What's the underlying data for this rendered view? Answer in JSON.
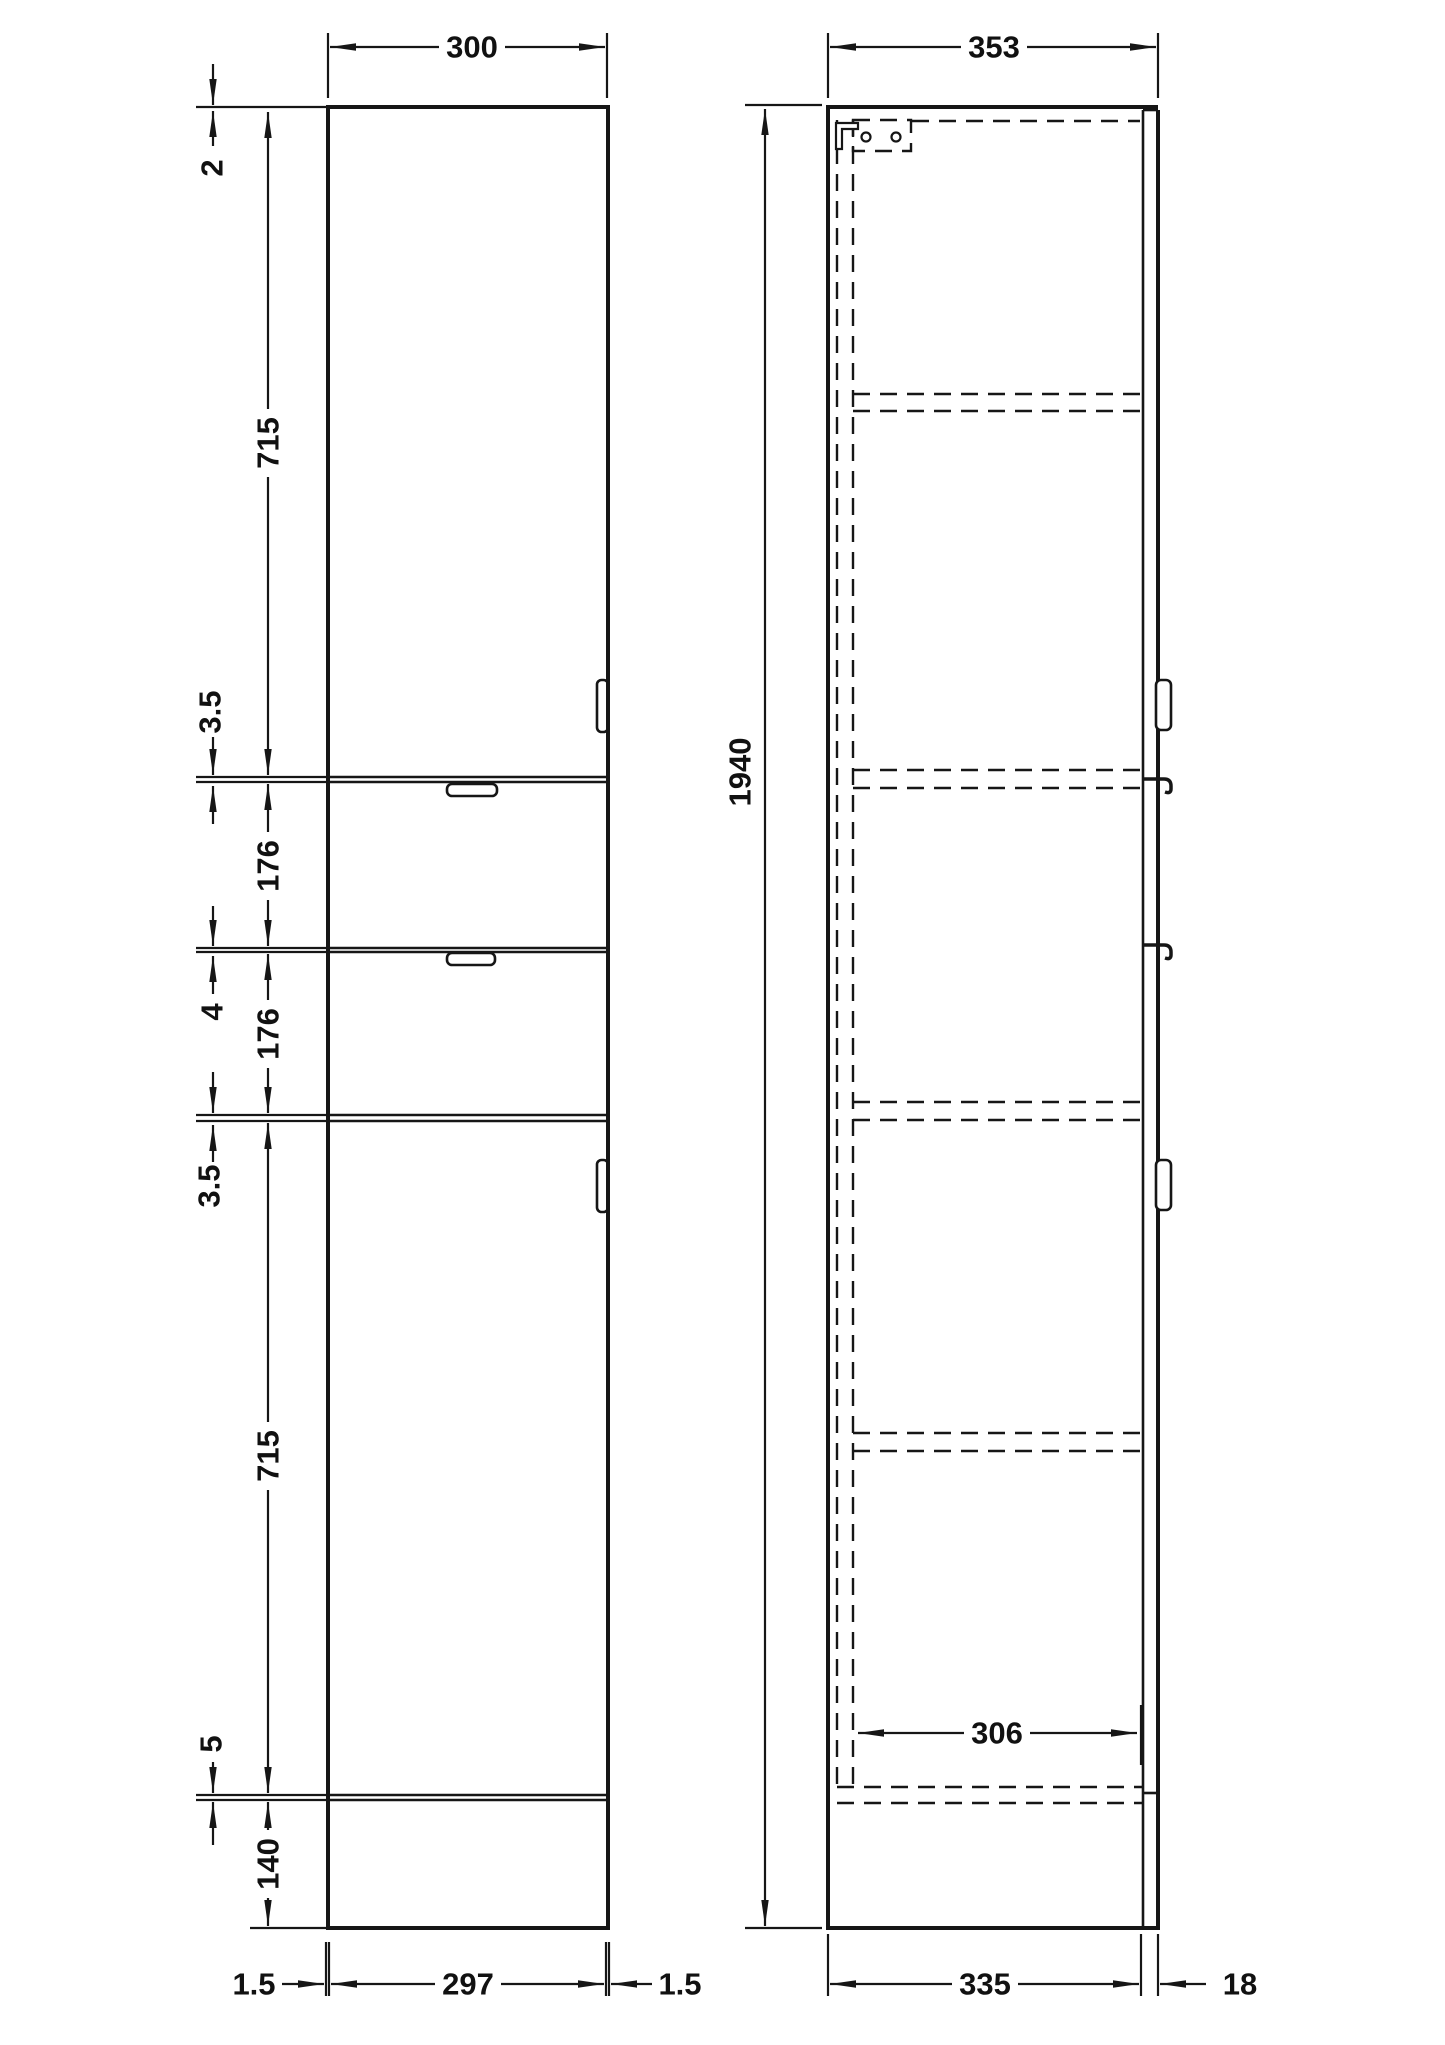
{
  "document": {
    "type": "technical-drawing",
    "subject": "Tall cabinet (tallboy) front and side elevations with dimensions",
    "units": "mm"
  },
  "colors": {
    "line": "#161616",
    "background": "#ffffff",
    "text": "#111111"
  },
  "front_view": {
    "width": "300",
    "segments": {
      "top_gap": "2",
      "upper_door": "715",
      "gap_door_drawer": "3.5",
      "upper_drawer": "176",
      "gap_between_drawers": "4",
      "lower_drawer": "176",
      "gap_drawer_door": "3.5",
      "lower_door": "715",
      "plinth_gap": "5",
      "plinth_height": "140"
    },
    "bottom": {
      "left_gap": "1.5",
      "door_width": "297",
      "right_gap": "1.5"
    }
  },
  "side_view": {
    "overall_depth": "353",
    "overall_height": "1940",
    "internal_depth": "306",
    "body_depth": "335",
    "front_thickness": "18"
  }
}
